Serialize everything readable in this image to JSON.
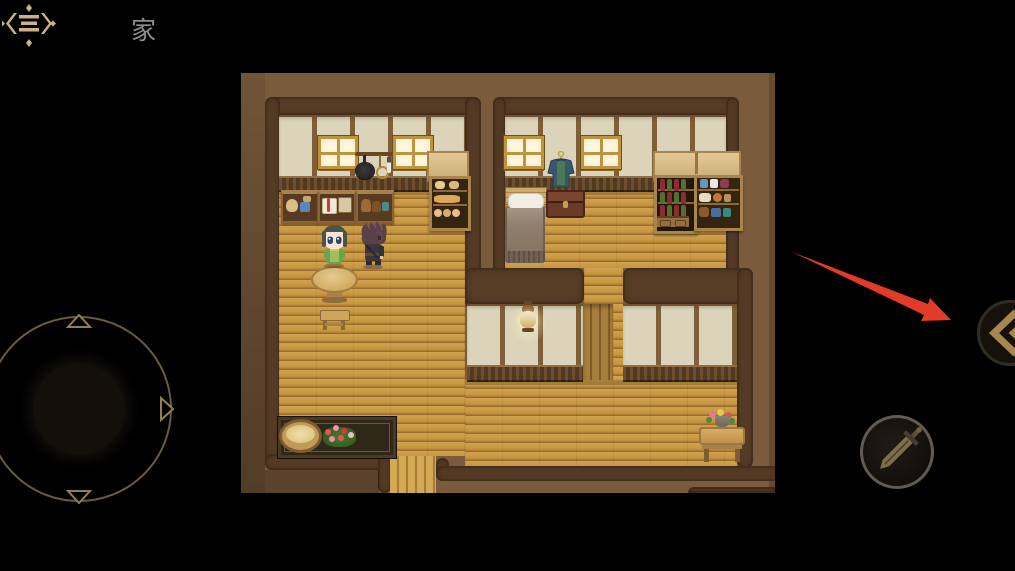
{
  "app": {
    "type": "mobile-rpg-game-screen",
    "background_color": "#000000"
  },
  "header": {
    "menu_icon": "ornate-menu-icon",
    "scene_title": "家",
    "title_color": "#8f8f8f"
  },
  "map": {
    "scene": "家 (home interior)",
    "rooms": [
      "kitchen",
      "bedroom",
      "hall",
      "lower-corridor"
    ],
    "objects": [
      "window",
      "window",
      "window",
      "window",
      "hanging-cookware-rack",
      "kitchen-counter-crates",
      "bread-shelf",
      "shelf-hood",
      "coat-on-wall",
      "bed",
      "storage-chest",
      "wine-rack",
      "cabinet-shelf",
      "round-table",
      "stool",
      "wall-lamp",
      "dark-counter",
      "bread-basket",
      "flower-box",
      "flower-table",
      "door-planks",
      "exit-corridor"
    ],
    "characters": [
      {
        "id": "npc-woman",
        "hair": "dark-green",
        "outfit": "green-dress",
        "facing": "down"
      },
      {
        "id": "player-man",
        "hair": "dark-plum",
        "outfit": "dark-tunic",
        "facing": "right"
      }
    ],
    "palette": {
      "exterior": "#7a5b3c",
      "wall_border": "#583d26",
      "wall_panel": "#dbd3ba",
      "floor": "#c79a45",
      "window_frame": "#bd9440"
    }
  },
  "controls": {
    "joystick": {
      "arrows": [
        "up",
        "right",
        "down",
        "left"
      ],
      "ring_color": "#6a5d3b"
    },
    "attack_button": {
      "icon": "sword-icon",
      "icon_color": "#7e7049"
    },
    "side_toggle_button": {
      "icon": "double-chevron-left-icon",
      "icon_color": "#a8874e"
    }
  },
  "annotation": {
    "shape": "red-arrow",
    "color": "#e23b27",
    "points_to": "side-toggle-button"
  }
}
